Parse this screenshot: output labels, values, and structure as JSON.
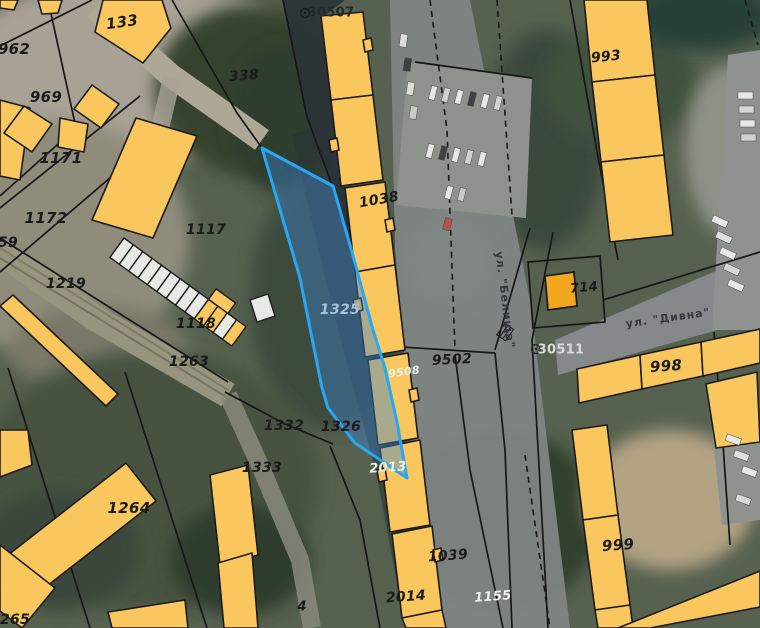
{
  "map": {
    "description": "cadastral-parcel-map-over-satellite-imagery",
    "selected_parcel": {
      "id": "1325",
      "fill": "#3c82cd",
      "stroke": "#25a8f5"
    },
    "colors": {
      "building_fill": "#f9c75e",
      "building_outline": "#1c1c1c",
      "garage_fill": "#e8e8e4",
      "orange_building_fill": "#f2a71f",
      "parcel_line": "#171717",
      "road_fill": "#868b85",
      "selected_fill": "#3c82cd",
      "selected_stroke": "#25a8f5",
      "label_dark": "#1b1b1b",
      "label_light": "#eef0ec"
    },
    "labels": [
      {
        "text": "133",
        "x": 122,
        "y": 22,
        "rot": -8,
        "size": 15,
        "color": "dark"
      },
      {
        "text": "134",
        "x": 172,
        "y": -4,
        "rot": 0,
        "size": 13,
        "color": "dark"
      },
      {
        "text": "962",
        "x": 14,
        "y": 49,
        "rot": 0,
        "size": 15,
        "color": "dark"
      },
      {
        "text": "969",
        "x": 46,
        "y": 97,
        "rot": 0,
        "size": 15,
        "color": "dark"
      },
      {
        "text": "338",
        "x": 244,
        "y": 76,
        "rot": -5,
        "size": 14,
        "color": "dark"
      },
      {
        "text": "30507",
        "x": 331,
        "y": 13,
        "rot": 0,
        "size": 13,
        "color": "survey"
      },
      {
        "text": "1171",
        "x": 61,
        "y": 158,
        "rot": 0,
        "size": 15,
        "color": "dark"
      },
      {
        "text": "1172",
        "x": 46,
        "y": 218,
        "rot": 0,
        "size": 15,
        "color": "dark"
      },
      {
        "text": "959",
        "x": 3,
        "y": 243,
        "rot": 0,
        "size": 14,
        "color": "dark"
      },
      {
        "text": "1219",
        "x": 66,
        "y": 284,
        "rot": 0,
        "size": 14,
        "color": "dark"
      },
      {
        "text": "1117",
        "x": 206,
        "y": 230,
        "rot": 0,
        "size": 14,
        "color": "dark"
      },
      {
        "text": "1118",
        "x": 196,
        "y": 324,
        "rot": 0,
        "size": 14,
        "color": "dark"
      },
      {
        "text": "1263",
        "x": 189,
        "y": 362,
        "rot": 0,
        "size": 14,
        "color": "dark"
      },
      {
        "text": "1325",
        "x": 340,
        "y": 310,
        "rot": 0,
        "size": 14,
        "color": "blue"
      },
      {
        "text": "1332",
        "x": 284,
        "y": 426,
        "rot": 0,
        "size": 14,
        "color": "dark"
      },
      {
        "text": "1326",
        "x": 341,
        "y": 427,
        "rot": 0,
        "size": 14,
        "color": "dark"
      },
      {
        "text": "1333",
        "x": 262,
        "y": 468,
        "rot": 0,
        "size": 14,
        "color": "dark"
      },
      {
        "text": "2013",
        "x": 388,
        "y": 468,
        "rot": -4,
        "size": 13,
        "color": "white"
      },
      {
        "text": "1264",
        "x": 129,
        "y": 508,
        "rot": 0,
        "size": 15,
        "color": "dark"
      },
      {
        "text": "1265",
        "x": 10,
        "y": 620,
        "rot": 0,
        "size": 14,
        "color": "dark"
      },
      {
        "text": "1038",
        "x": 379,
        "y": 200,
        "rot": -10,
        "size": 14,
        "color": "dark"
      },
      {
        "text": "9502",
        "x": 452,
        "y": 360,
        "rot": -3,
        "size": 14,
        "color": "dark"
      },
      {
        "text": "9508",
        "x": 404,
        "y": 372,
        "rot": -8,
        "size": 11,
        "color": "white"
      },
      {
        "text": "714",
        "x": 584,
        "y": 288,
        "rot": -5,
        "size": 13,
        "color": "dark"
      },
      {
        "text": "30511",
        "x": 561,
        "y": 350,
        "rot": 0,
        "size": 13,
        "color": "survey-light"
      },
      {
        "text": "993",
        "x": 606,
        "y": 57,
        "rot": -6,
        "size": 14,
        "color": "dark"
      },
      {
        "text": "998",
        "x": 666,
        "y": 366,
        "rot": -4,
        "size": 15,
        "color": "dark"
      },
      {
        "text": "999",
        "x": 618,
        "y": 545,
        "rot": -4,
        "size": 15,
        "color": "dark"
      },
      {
        "text": "1039",
        "x": 448,
        "y": 556,
        "rot": -4,
        "size": 14,
        "color": "dark"
      },
      {
        "text": "2014",
        "x": 406,
        "y": 597,
        "rot": -4,
        "size": 14,
        "color": "dark"
      },
      {
        "text": "1155",
        "x": 493,
        "y": 597,
        "rot": -4,
        "size": 13,
        "color": "white"
      },
      {
        "text": "4",
        "x": 302,
        "y": 607,
        "rot": 0,
        "size": 13,
        "color": "dark"
      }
    ],
    "street_labels": [
      {
        "text": "ул. \"Белища\"",
        "x": 505,
        "y": 300,
        "rot": 83,
        "size": 11,
        "color": "street"
      },
      {
        "text": "ул. \"Дивна\"",
        "x": 668,
        "y": 318,
        "rot": -8,
        "size": 11,
        "color": "street"
      }
    ],
    "survey_points": [
      {
        "id": "30507",
        "x": 305,
        "y": 13
      },
      {
        "id": "30511",
        "x": 536,
        "y": 349
      }
    ]
  }
}
